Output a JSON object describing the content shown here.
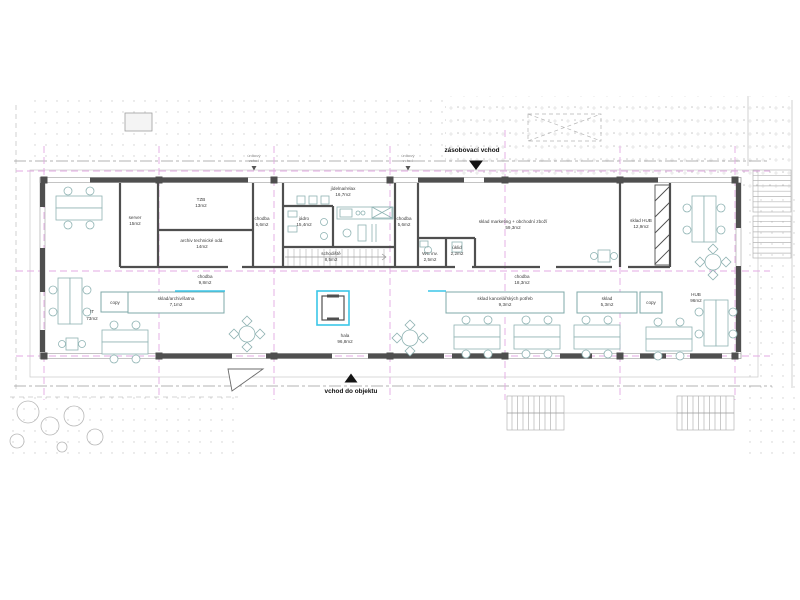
{
  "drawing": {
    "type": "architectural-floor-plan",
    "entrances": {
      "supply": "zásobovací vchod",
      "main": "vchod do objektu",
      "escape_left_line1": "únikový",
      "escape_left_line2": "vchod",
      "escape_right_line1": "únikový",
      "escape_right_line2": "vchod"
    },
    "rooms": [
      {
        "name": "server",
        "area": "15m2"
      },
      {
        "name": "TZB",
        "area": "13m2"
      },
      {
        "name": "archiv technické odd.",
        "area": "14m2"
      },
      {
        "name": "chodba",
        "area": "9,8m2"
      },
      {
        "name": "chodba",
        "area": "5,6m2"
      },
      {
        "name": "jídelna/relax",
        "area": "16,7m2"
      },
      {
        "name": "jádro",
        "area": "15,4m2"
      },
      {
        "name": "schodiště",
        "area": "8,5m2"
      },
      {
        "name": "chodba",
        "area": "5,6m2"
      },
      {
        "name": "WC inv.",
        "area": "2,5m2"
      },
      {
        "name": "úklid",
        "area": "2,2m2"
      },
      {
        "name": "sklad marketing + obchodní zboží",
        "area": "59,3m2"
      },
      {
        "name": "sklad HUB",
        "area": "12,9m2"
      },
      {
        "name": "chodba",
        "area": "18,3m2"
      },
      {
        "name": "sklad kancelářských potřeb",
        "area": "9,3m2"
      },
      {
        "name": "sklad",
        "area": "5,3m2"
      },
      {
        "name": "sklad/archiv/šatna",
        "area": "7,1m2"
      },
      {
        "name": "IT",
        "area": "73m2"
      },
      {
        "name": "hala",
        "area": "96,8m2"
      },
      {
        "name": "HUB",
        "area": "96m2"
      },
      {
        "name": "copy",
        "area": ""
      },
      {
        "name": "copy",
        "area": ""
      }
    ],
    "colors": {
      "walls": "#4f4f4f",
      "grid": "#e3aae3",
      "furniture": "#8fb3b3",
      "highlight": "#3bc6e8",
      "background": "#ffffff"
    }
  }
}
